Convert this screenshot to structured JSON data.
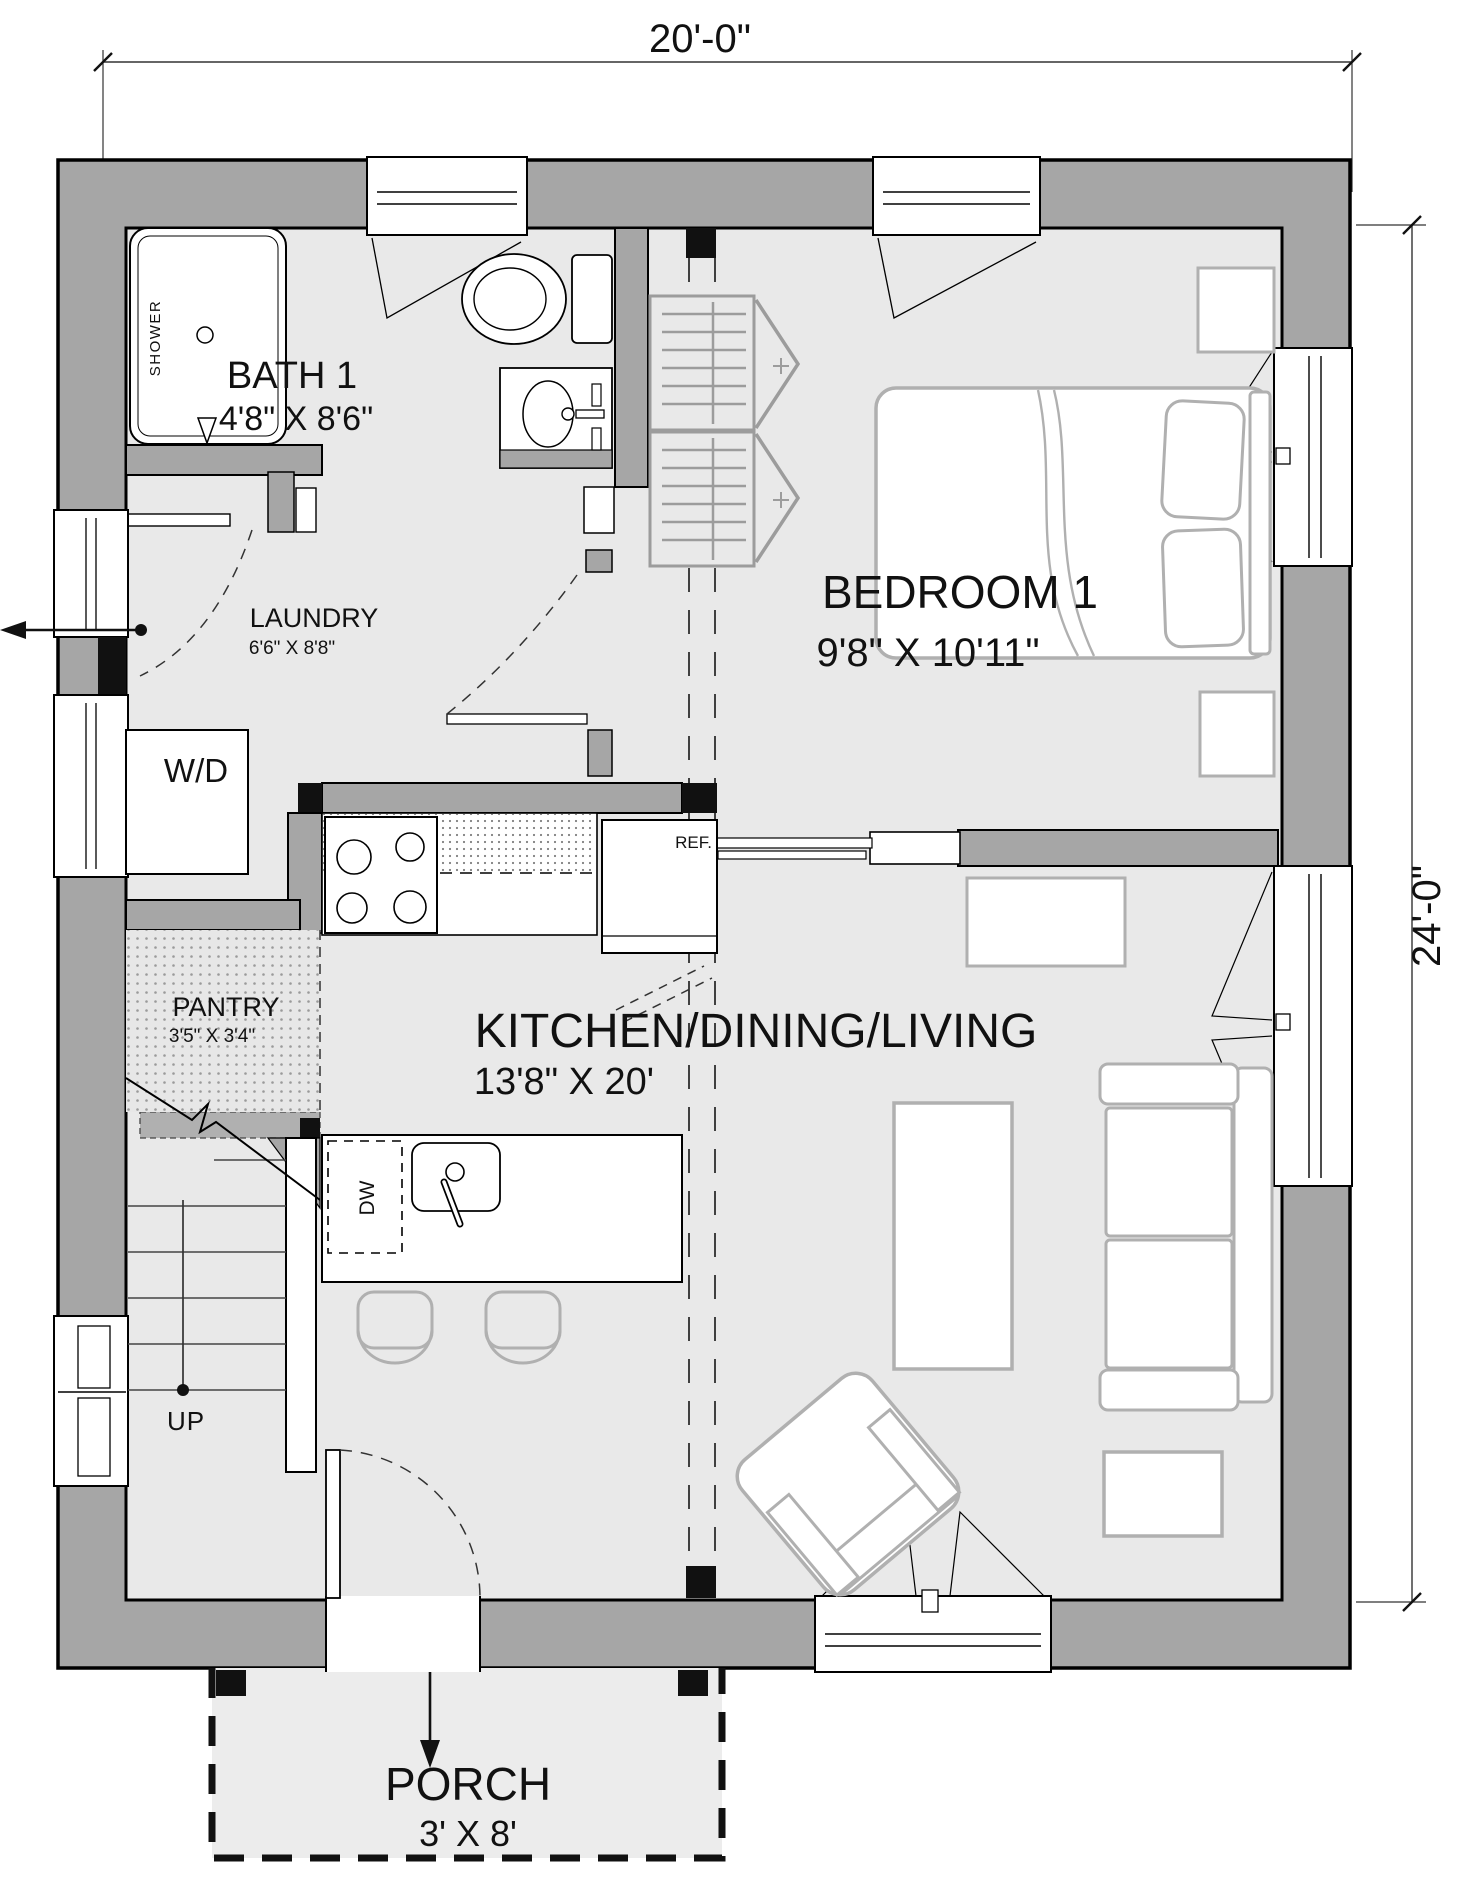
{
  "dimensions": {
    "top": "20'-0\"",
    "right": "24'-0\""
  },
  "rooms": {
    "bath": {
      "name": "BATH 1",
      "size": "4'8\" X 8'6\""
    },
    "bedroom": {
      "name": "BEDROOM 1",
      "size": "9'8\" X 10'11\""
    },
    "laundry": {
      "name": "LAUNDRY",
      "size": "6'6\" X 8'8\""
    },
    "pantry": {
      "name": "PANTRY",
      "size": "3'5\" X 3'4\""
    },
    "kitchen": {
      "name": "KITCHEN/DINING/LIVING",
      "size": "13'8\" X 20'"
    },
    "porch": {
      "name": "PORCH",
      "size": "3' X 8'"
    }
  },
  "fixtures": {
    "shower": "SHOWER",
    "washer_dryer": "W/D",
    "refrigerator": "REF.",
    "dishwasher": "DW",
    "stairs_up": "UP"
  },
  "colors": {
    "wall": "#a6a6a6",
    "floor": "#e9e9e9",
    "furniture_outline": "#b0b0b0",
    "line": "#111111"
  }
}
